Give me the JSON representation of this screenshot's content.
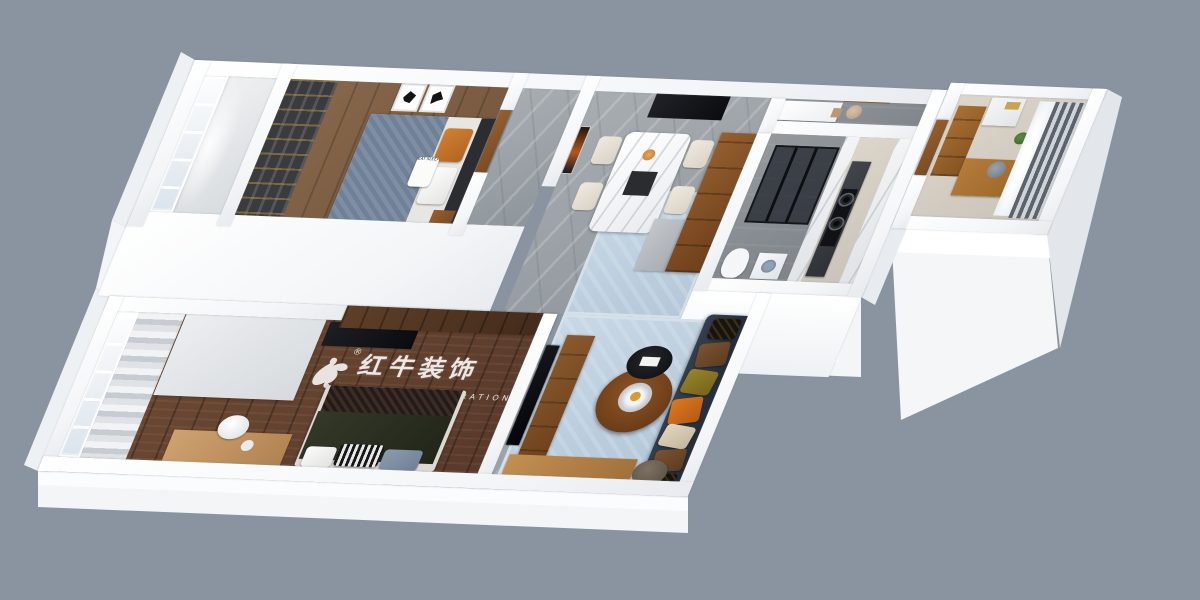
{
  "watermark": {
    "brand_zh": "红牛装饰",
    "brand_en": "HONG NIU DECORATION",
    "registered_mark": "®",
    "logo": "bull-swoosh-logo"
  },
  "bedroom_pillow_text": "EAT SLEEP",
  "palette": {
    "background": "#8a94a1",
    "wall_white": "#f6f8f9",
    "rug_blue": "#c1d2e1",
    "sofa_navy": "#2e3744",
    "accent_orange": "#c96a1e",
    "wood_cabinet": "#8a5a2d",
    "wood_floor_master": "#6a4a33",
    "marble_floor_gray": "#9aa0a5",
    "shower_glass": "#1c2028"
  }
}
